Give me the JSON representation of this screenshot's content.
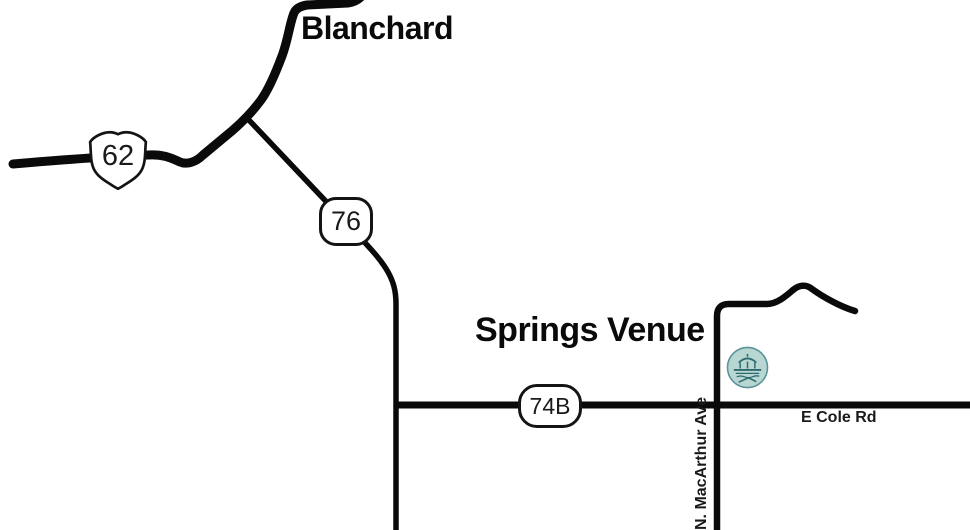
{
  "map": {
    "town": {
      "label": "Blanchard"
    },
    "venue": {
      "label": "Springs Venue"
    },
    "shields": {
      "us62": "62",
      "sh76": "76",
      "sh74b": "74B"
    },
    "streets": {
      "macarthur": "N. MacArthur Ave",
      "cole": "E Cole Rd"
    },
    "colors": {
      "road": "#0a0a0a",
      "shield_fill": "#ffffff",
      "shield_border": "#141414",
      "venue_icon_fill": "#b8d7d3",
      "venue_icon_line": "#2e6b70"
    }
  }
}
